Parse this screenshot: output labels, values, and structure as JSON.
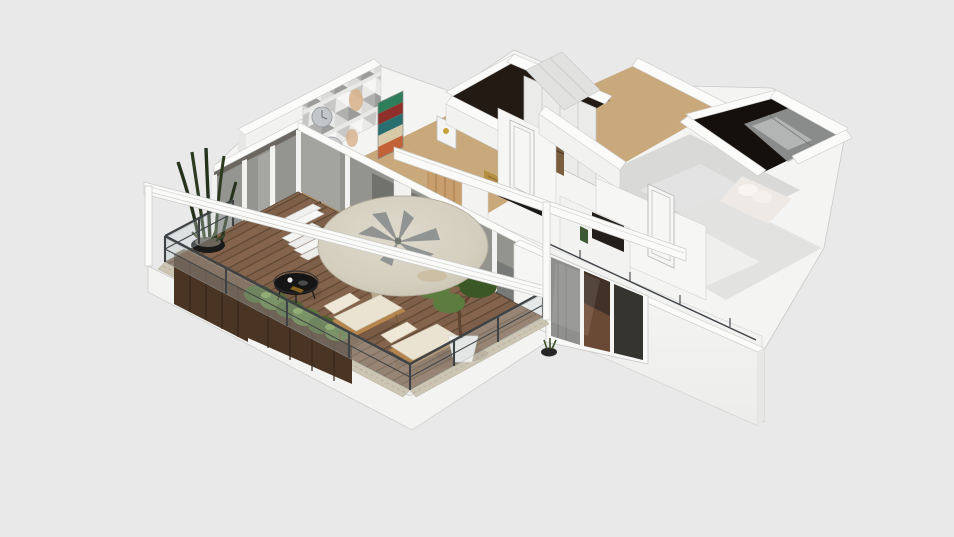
{
  "meta": {
    "description": "3D isometric-perspective render of a single-storey apartment floor plan, viewed from above. Large L-shaped wooden-deck terrace with glass balustrade in the foreground; white-walled interior rooms behind.",
    "view": "3d-birdseye-perspective",
    "visible_text": []
  },
  "scene": {
    "rooms": [
      {
        "name": "terrace",
        "floor": "wood deck",
        "features": [
          "glass railing",
          "wood planters",
          "hedge plants",
          "succulent bowl",
          "snake plant",
          "pampas vase",
          "black coffee table",
          "two loungers",
          "potted tree",
          "round parasol with palm decor",
          "white outdoor stairs",
          "roof fascia beams"
        ]
      },
      {
        "name": "living-dining",
        "floor": "wood",
        "features": [
          "triangle-pattern accent wall",
          "two wall clocks",
          "chevron artwork",
          "dark dining chair",
          "sliding glass doors",
          "wood slat partition",
          "framed art"
        ]
      },
      {
        "name": "hallway",
        "floor": "wood",
        "features": [
          "white door",
          "wardrobe closet",
          "gold artwork"
        ]
      },
      {
        "name": "top-bathroom",
        "floor": "black marble",
        "features": [
          "white cabinet"
        ]
      },
      {
        "name": "right-bathroom",
        "floor": "black marble",
        "features": [
          "glass shower"
        ]
      },
      {
        "name": "bedroom",
        "floor": "grey gloss tile",
        "features": [
          "white door",
          "dark artwork",
          "bed with pillows"
        ]
      },
      {
        "name": "exterior",
        "features": [
          "white facade wall",
          "three-pane window with curtain",
          "thin metal guard rail"
        ]
      }
    ]
  },
  "colors": {
    "bg": "#e9e9e9",
    "under_fill": "#f4f4f3",
    "plinth": "#f3f3f1",
    "wall_top": "#fbfbfa",
    "wall_face": "#f2f2f1",
    "wall_face_bright": "#f6f6f5",
    "wall_shade": "#e7e7e5",
    "outline": "#c9c9c7",
    "beam_white": "#fafaf9",
    "deck_base": "#7e604a",
    "deck_stripe": "#745642",
    "deck_stripe_dark": "#5e4631",
    "border_stone": "#ccc5b4",
    "planter_wood": "#4a3424",
    "planter_wood_light": "#6b4e36",
    "hedge_green": "#5a7a3a",
    "hedge_dark": "#49652e",
    "hedge_light": "#7ba050",
    "foliage": "#4c682f",
    "foliage_light": "#5d7d40",
    "foliage_dark": "#3c5726",
    "trunk": "#5d4330",
    "parasol": "#d8d2c3",
    "parasol_edge": "#b5ae9e",
    "palm_gray": "#8d9190",
    "glass": "#c8d2d1",
    "railing_metal": "#3f4346",
    "door_white": "#f6f6f5",
    "interior_dark": "#6b6660",
    "window_glass": "#35342f",
    "curtain_gray": "#8f8f8d",
    "floor_wood": "#c9a87c",
    "floor_wood_dark": "#b9915f",
    "marble_dark": "#221a13",
    "marble_dark2": "#16100c",
    "tile_gray": "#d9d9d8",
    "tile_light": "#e2e2e1",
    "gold_art": "#b68f43",
    "table_black": "#151515",
    "cushion": "#eae3d2",
    "lounger_wood": "#b5854e",
    "pot_white": "#f0f0ed",
    "pampas": "#d9c9a6",
    "bed_linen": "#efe9e6",
    "art_teal": "#2a6f6f",
    "art_green": "#2e7d5b",
    "art_red": "#8f2f2a",
    "art_cream": "#d8c9a8",
    "art_orange": "#c26236"
  }
}
